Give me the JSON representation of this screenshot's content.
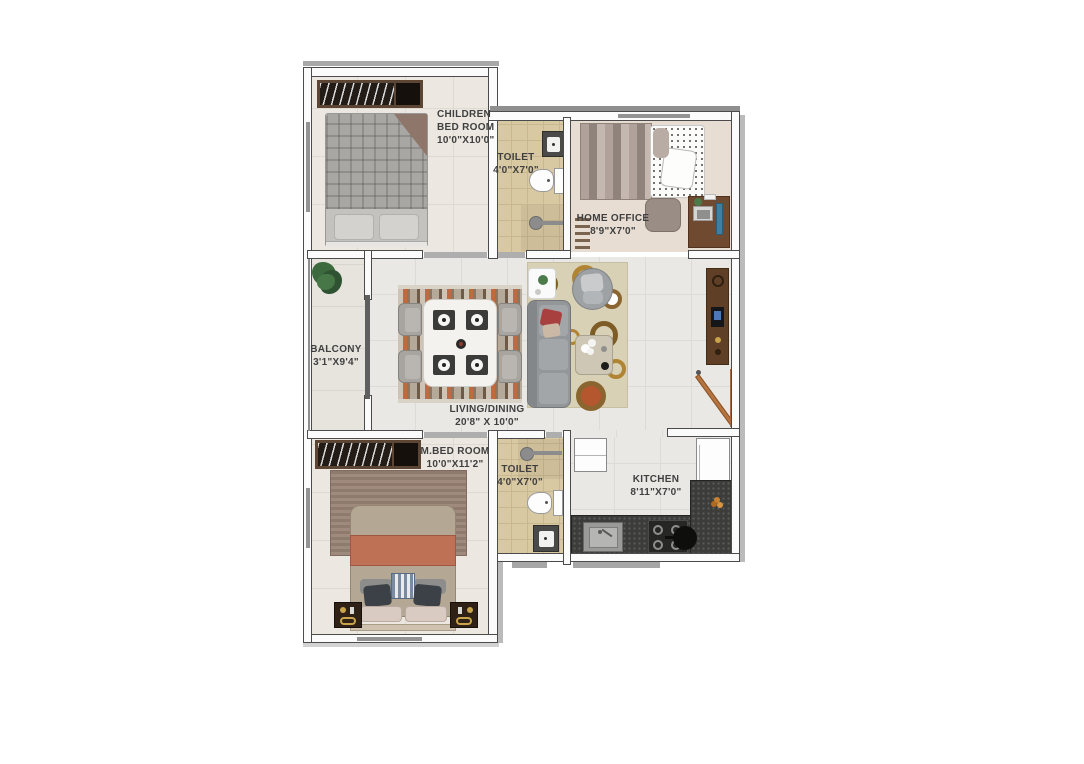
{
  "floor_plan": {
    "rooms": [
      {
        "id": "children-bedroom",
        "lines": [
          "CHILDREN",
          "BED ROOM",
          "10'0\"X10'0\""
        ]
      },
      {
        "id": "toilet-upper",
        "lines": [
          "TOILET",
          "4'0\"X7'0\""
        ]
      },
      {
        "id": "home-office",
        "lines": [
          "HOME OFFICE",
          "8'9\"X7'0\""
        ]
      },
      {
        "id": "balcony",
        "lines": [
          "BALCONY",
          "3'1\"X9'4\""
        ]
      },
      {
        "id": "living-dining",
        "lines": [
          "LIVING/DINING",
          "20'8\" X 10'0\""
        ]
      },
      {
        "id": "master-bedroom",
        "lines": [
          "M.BED ROOM",
          "10'0\"X11'2\""
        ]
      },
      {
        "id": "toilet-lower",
        "lines": [
          "TOILET",
          "4'0\"X7'0\""
        ]
      },
      {
        "id": "kitchen",
        "lines": [
          "KITCHEN",
          "8'11\"X7'0\""
        ]
      }
    ],
    "colors": {
      "wall_fill": "#fbfbfb",
      "wall_line": "#4b4b4b",
      "living_floor": "#e9e8e5",
      "bedroom_floor": "#ece8e1",
      "toilet_floor": "#d9c9a2",
      "office_floor": "#e8ddd2",
      "balcony_floor": "#e7e4de",
      "kitchen_counter": "#3c3c3a",
      "wood_furniture": "#6f4a30",
      "accent_terracotta": "#bf7156",
      "label_text": "#3f3f3f"
    }
  }
}
